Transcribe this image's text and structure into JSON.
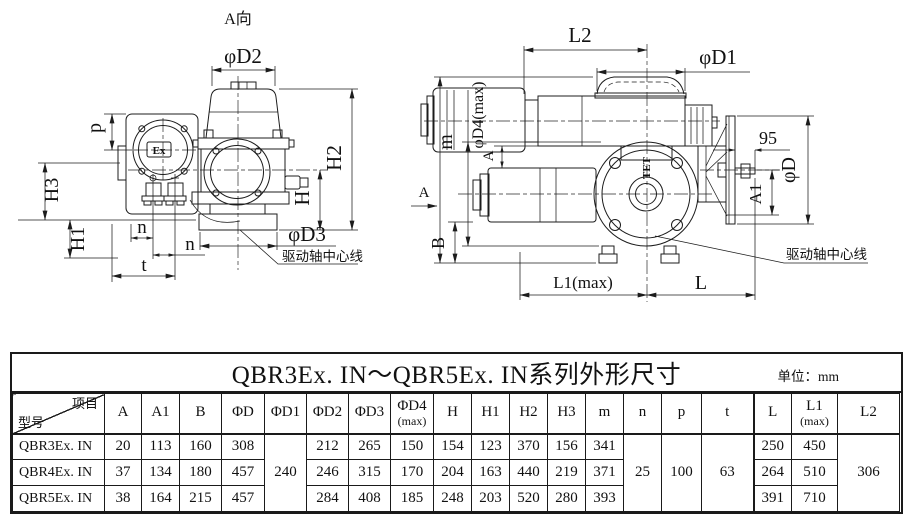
{
  "drawings": {
    "left_view": {
      "view_label": "A向",
      "logo_text": "Ex",
      "annotation": "驱动轴中心线",
      "dim_labels": {
        "d2": "φD2",
        "h2": "H2",
        "h": "H",
        "d3": "φD3",
        "p": "p",
        "h3": "H3",
        "h1": "H1",
        "n1": "n",
        "n2": "n",
        "t": "t"
      }
    },
    "side_view": {
      "view_arrow_label": "A",
      "logo_text": "TET",
      "annotation": "驱动轴中心线",
      "dim_labels": {
        "l2": "L2",
        "d1": "φD1",
        "m": "m",
        "d4": "φD4(max)",
        "a": "A",
        "b": "B",
        "ninety_five": "95",
        "d": "φD",
        "a1": "A1",
        "l1": "L1(max)",
        "l": "L"
      }
    }
  },
  "table": {
    "title": "QBR3Ex. IN～QBR5Ex. IN系列外形尺寸",
    "unit_label": "单位：mm",
    "corner": {
      "top_right": "项目",
      "bottom_left": "型号"
    },
    "columns": [
      {
        "key": "A",
        "main": "A"
      },
      {
        "key": "A1",
        "main": "A1"
      },
      {
        "key": "B",
        "main": "B"
      },
      {
        "key": "D",
        "main": "ΦD"
      },
      {
        "key": "D1",
        "main": "ΦD1"
      },
      {
        "key": "D2",
        "main": "ΦD2"
      },
      {
        "key": "D3",
        "main": "ΦD3"
      },
      {
        "key": "D4",
        "main": "ΦD4",
        "sub": "(max)"
      },
      {
        "key": "H",
        "main": "H"
      },
      {
        "key": "H1",
        "main": "H1"
      },
      {
        "key": "H2",
        "main": "H2"
      },
      {
        "key": "H3",
        "main": "H3"
      },
      {
        "key": "m",
        "main": "m"
      },
      {
        "key": "n",
        "main": "n"
      },
      {
        "key": "p",
        "main": "p"
      },
      {
        "key": "t",
        "main": "t"
      },
      {
        "key": "L",
        "main": "L"
      },
      {
        "key": "L1",
        "main": "L1",
        "sub": "(max)"
      },
      {
        "key": "L2",
        "main": "L2"
      }
    ],
    "merged": {
      "D1": "240",
      "n": "25",
      "p": "100",
      "t": "63",
      "L2": "306"
    },
    "rows": [
      {
        "model": "QBR3Ex. IN",
        "A": "20",
        "A1": "113",
        "B": "160",
        "D": "308",
        "D2": "212",
        "D3": "265",
        "D4": "150",
        "H": "154",
        "H1": "123",
        "H2": "370",
        "H3": "156",
        "m": "341",
        "L": "250",
        "L1": "450"
      },
      {
        "model": "QBR4Ex. IN",
        "A": "37",
        "A1": "134",
        "B": "180",
        "D": "457",
        "D2": "246",
        "D3": "315",
        "D4": "170",
        "H": "204",
        "H1": "163",
        "H2": "440",
        "H3": "219",
        "m": "371",
        "L": "264",
        "L1": "510"
      },
      {
        "model": "QBR5Ex. IN",
        "A": "38",
        "A1": "164",
        "B": "215",
        "D": "457",
        "D2": "284",
        "D3": "408",
        "D4": "185",
        "H": "248",
        "H1": "203",
        "H2": "520",
        "H3": "280",
        "m": "393",
        "L": "391",
        "L1": "710"
      }
    ]
  }
}
